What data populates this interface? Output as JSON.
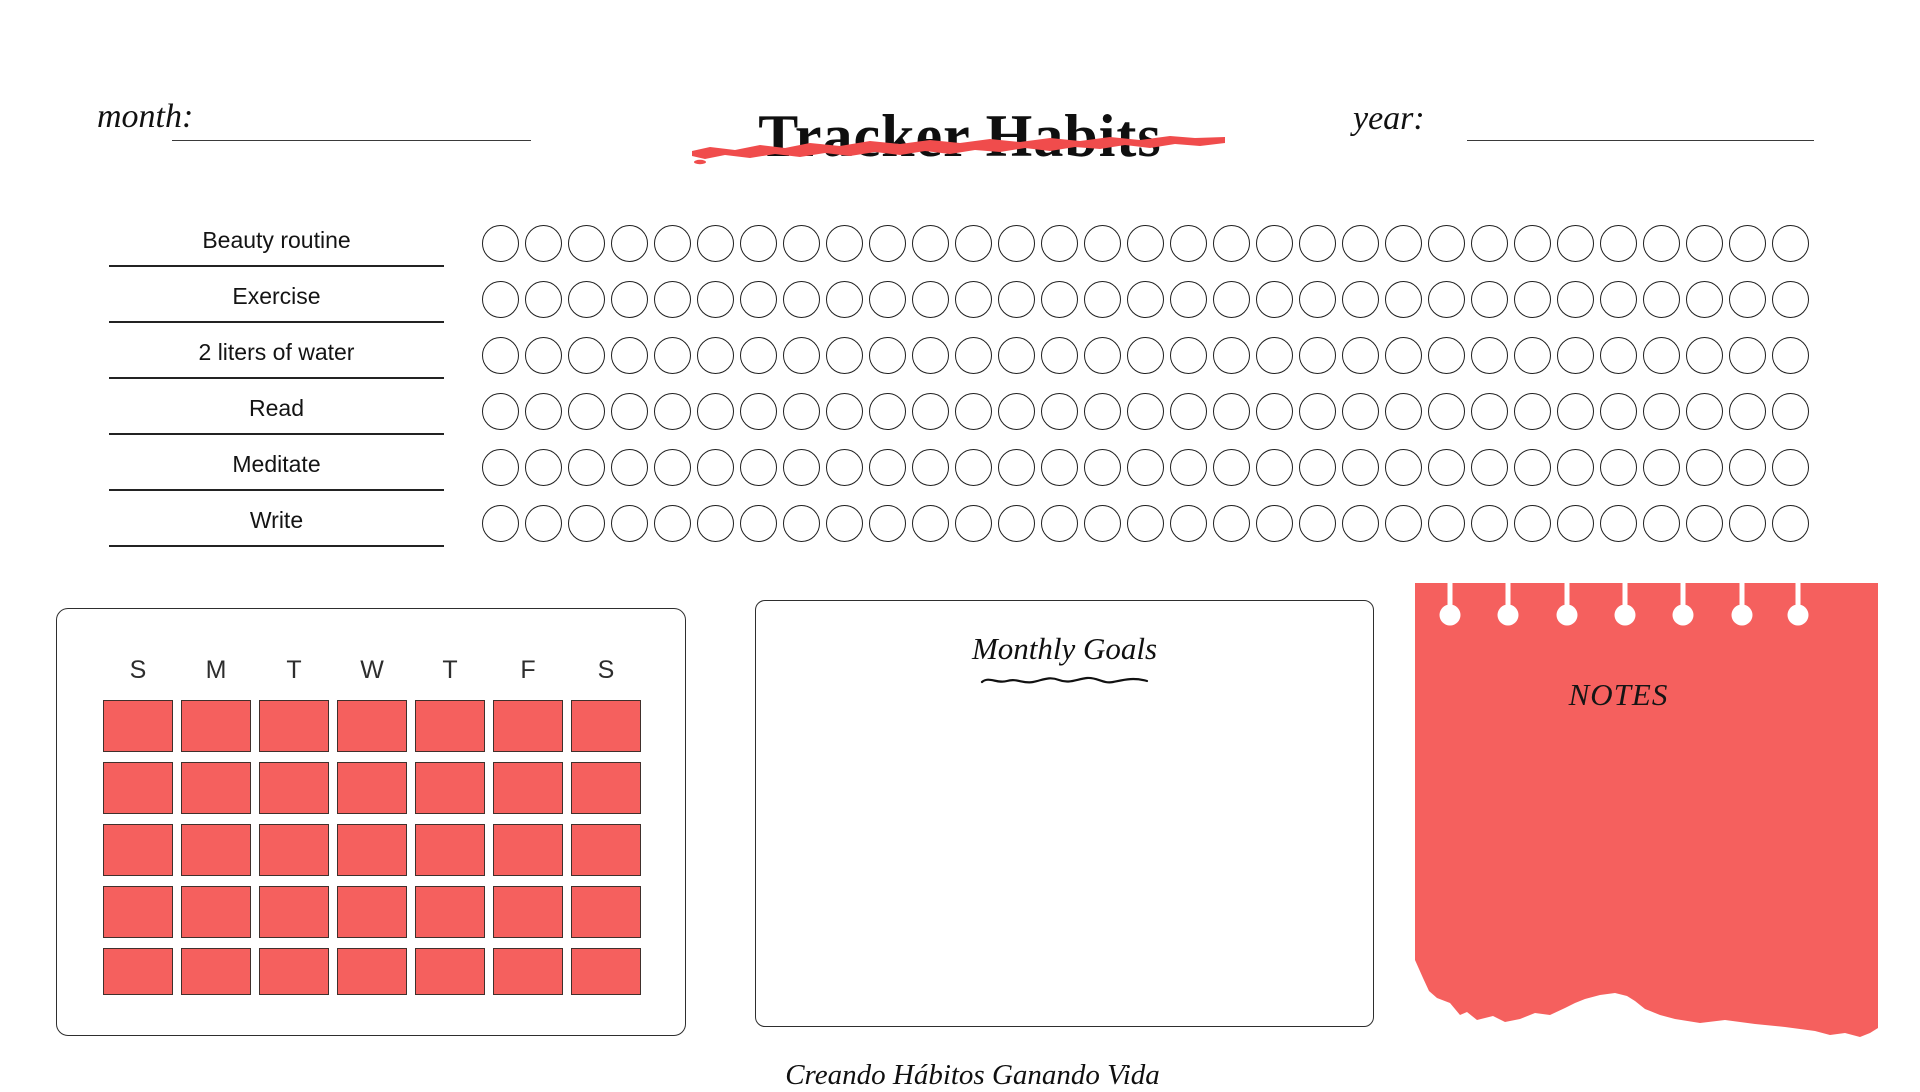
{
  "header": {
    "title": "Tracker Habits",
    "month_label": "month:",
    "month_value": "",
    "year_label": "year:",
    "year_value": ""
  },
  "habit_tracker": {
    "habits": [
      "Beauty routine",
      "Exercise",
      "2 liters of water",
      "Read",
      "Meditate",
      "Write"
    ],
    "days_per_row": 31
  },
  "calendar": {
    "day_headers": [
      "S",
      "M",
      "T",
      "W",
      "T",
      "F",
      "S"
    ],
    "week_rows": 5,
    "columns": 7
  },
  "monthly_goals": {
    "title": "Monthly Goals",
    "body": ""
  },
  "notes": {
    "title": "NOTES",
    "hole_count": 7,
    "body": ""
  },
  "footer": {
    "quote": "Creando Hábitos Ganando Vida"
  },
  "colors": {
    "coral": "#f5605e",
    "brush_red": "#f04c4c",
    "ink": "#1a1a1a"
  }
}
